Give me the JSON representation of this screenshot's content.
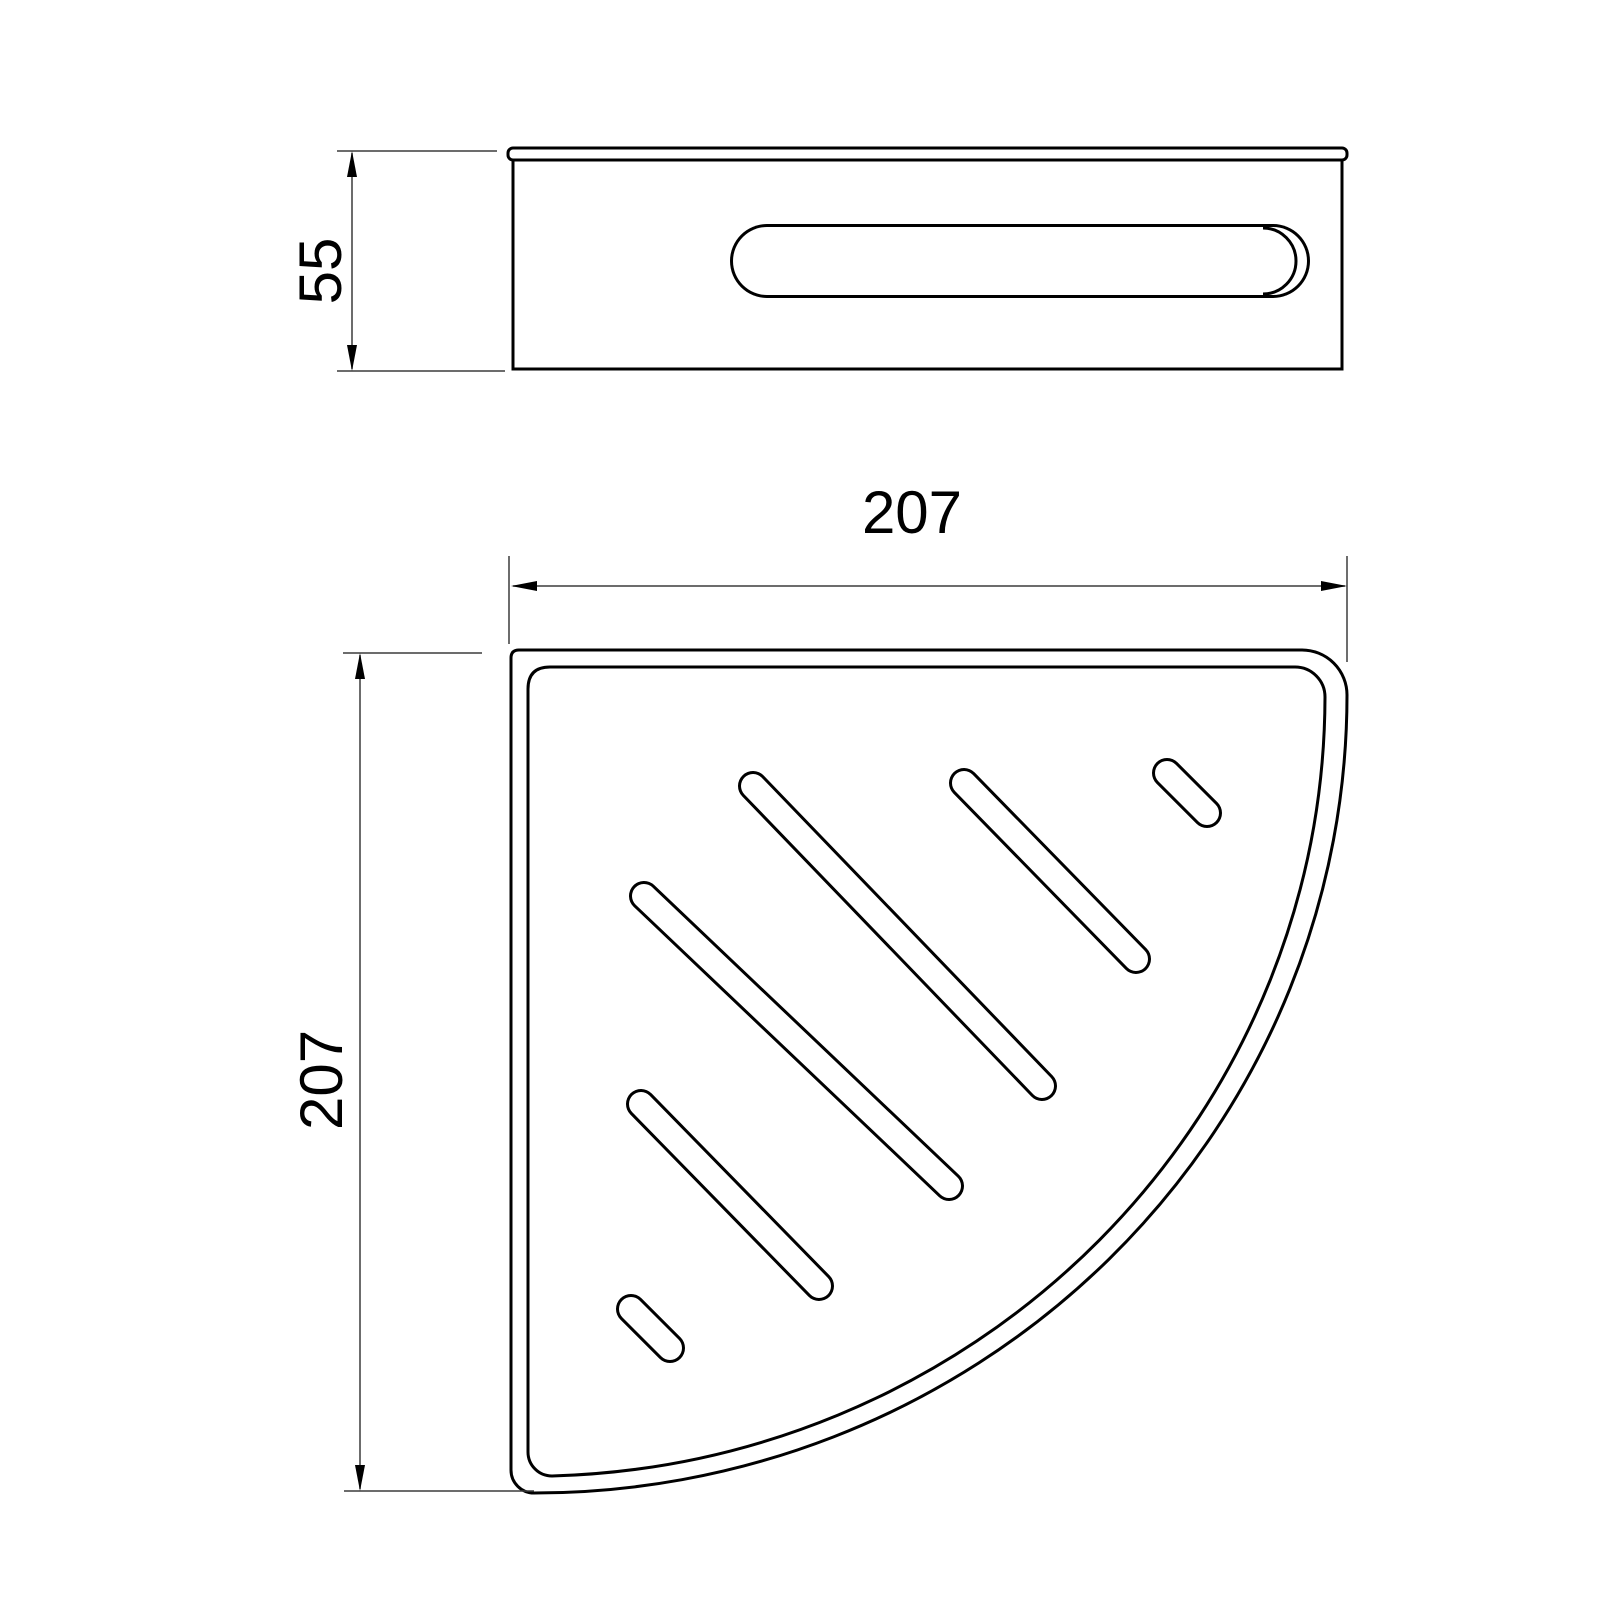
{
  "drawing": {
    "kind": "orthographic technical drawing, two views of a corner basket shelf",
    "background": "#ffffff",
    "outline_color": "#000000",
    "dim_color": "#3c3c3c",
    "views": {
      "front_view": "side elevation with wall-mount slot",
      "plan_view": "quarter-circle tray with 6 diagonal drain slots"
    },
    "dims": {
      "height": "55",
      "width": "207",
      "depth": "207"
    },
    "slot_count": 6
  }
}
